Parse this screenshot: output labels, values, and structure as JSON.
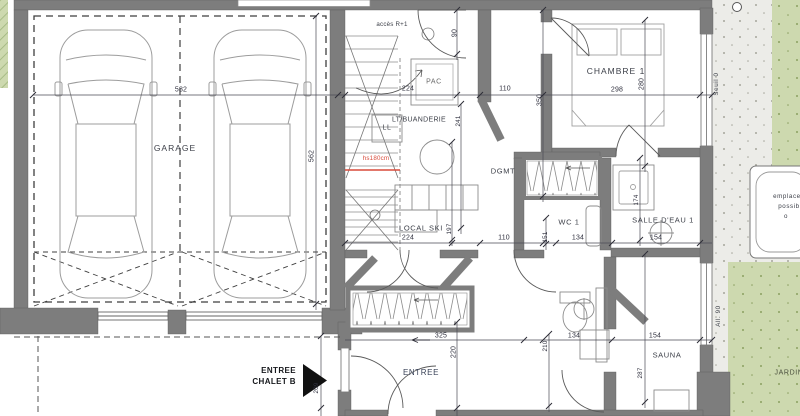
{
  "labels": {
    "garage": "GARAGE",
    "stair_access": "accès R+1",
    "pac": "PAC",
    "laundry": "LT/BUANDERIE",
    "washer": "LL",
    "headroom": "hs180cm",
    "ski_room": "LOCAL SKI",
    "hallway": "DGMT",
    "bedroom1": "CHAMBRE 1",
    "wc1": "WC 1",
    "bathroom1": "SALLE D'EAU 1",
    "entrance": "ENTREE",
    "sauna": "SAUNA",
    "garden": "JARDIN",
    "threshold": "Seuil 0",
    "sill": "All. 90",
    "chalet_entry_line1": "ENTREE",
    "chalet_entry_line2": "CHALET B",
    "spa_line1": "emplacement",
    "spa_line2": "possible",
    "spa_line3": "o"
  },
  "dimensions": {
    "garage_width": "582",
    "garage_depth": "562",
    "stair_bay_width": "224",
    "hall_width_top": "110",
    "bedroom_width": "298",
    "top_offset": "90",
    "bedroom_depth": "350",
    "bed_width": "280",
    "laundry_depth": "241",
    "ski_width": "224",
    "hall_width_mid": "110",
    "wc_offset": "151",
    "wc_width": "134",
    "bathroom_width": "154",
    "ski_depth": "197",
    "bathroom_depth": "174",
    "entry_width": "325",
    "entry_depth": "220",
    "lower_wc_width": "134",
    "entry_right_depth": "210",
    "sauna_width": "154",
    "sauna_depth": "287",
    "chalet_entry_width": "209"
  }
}
